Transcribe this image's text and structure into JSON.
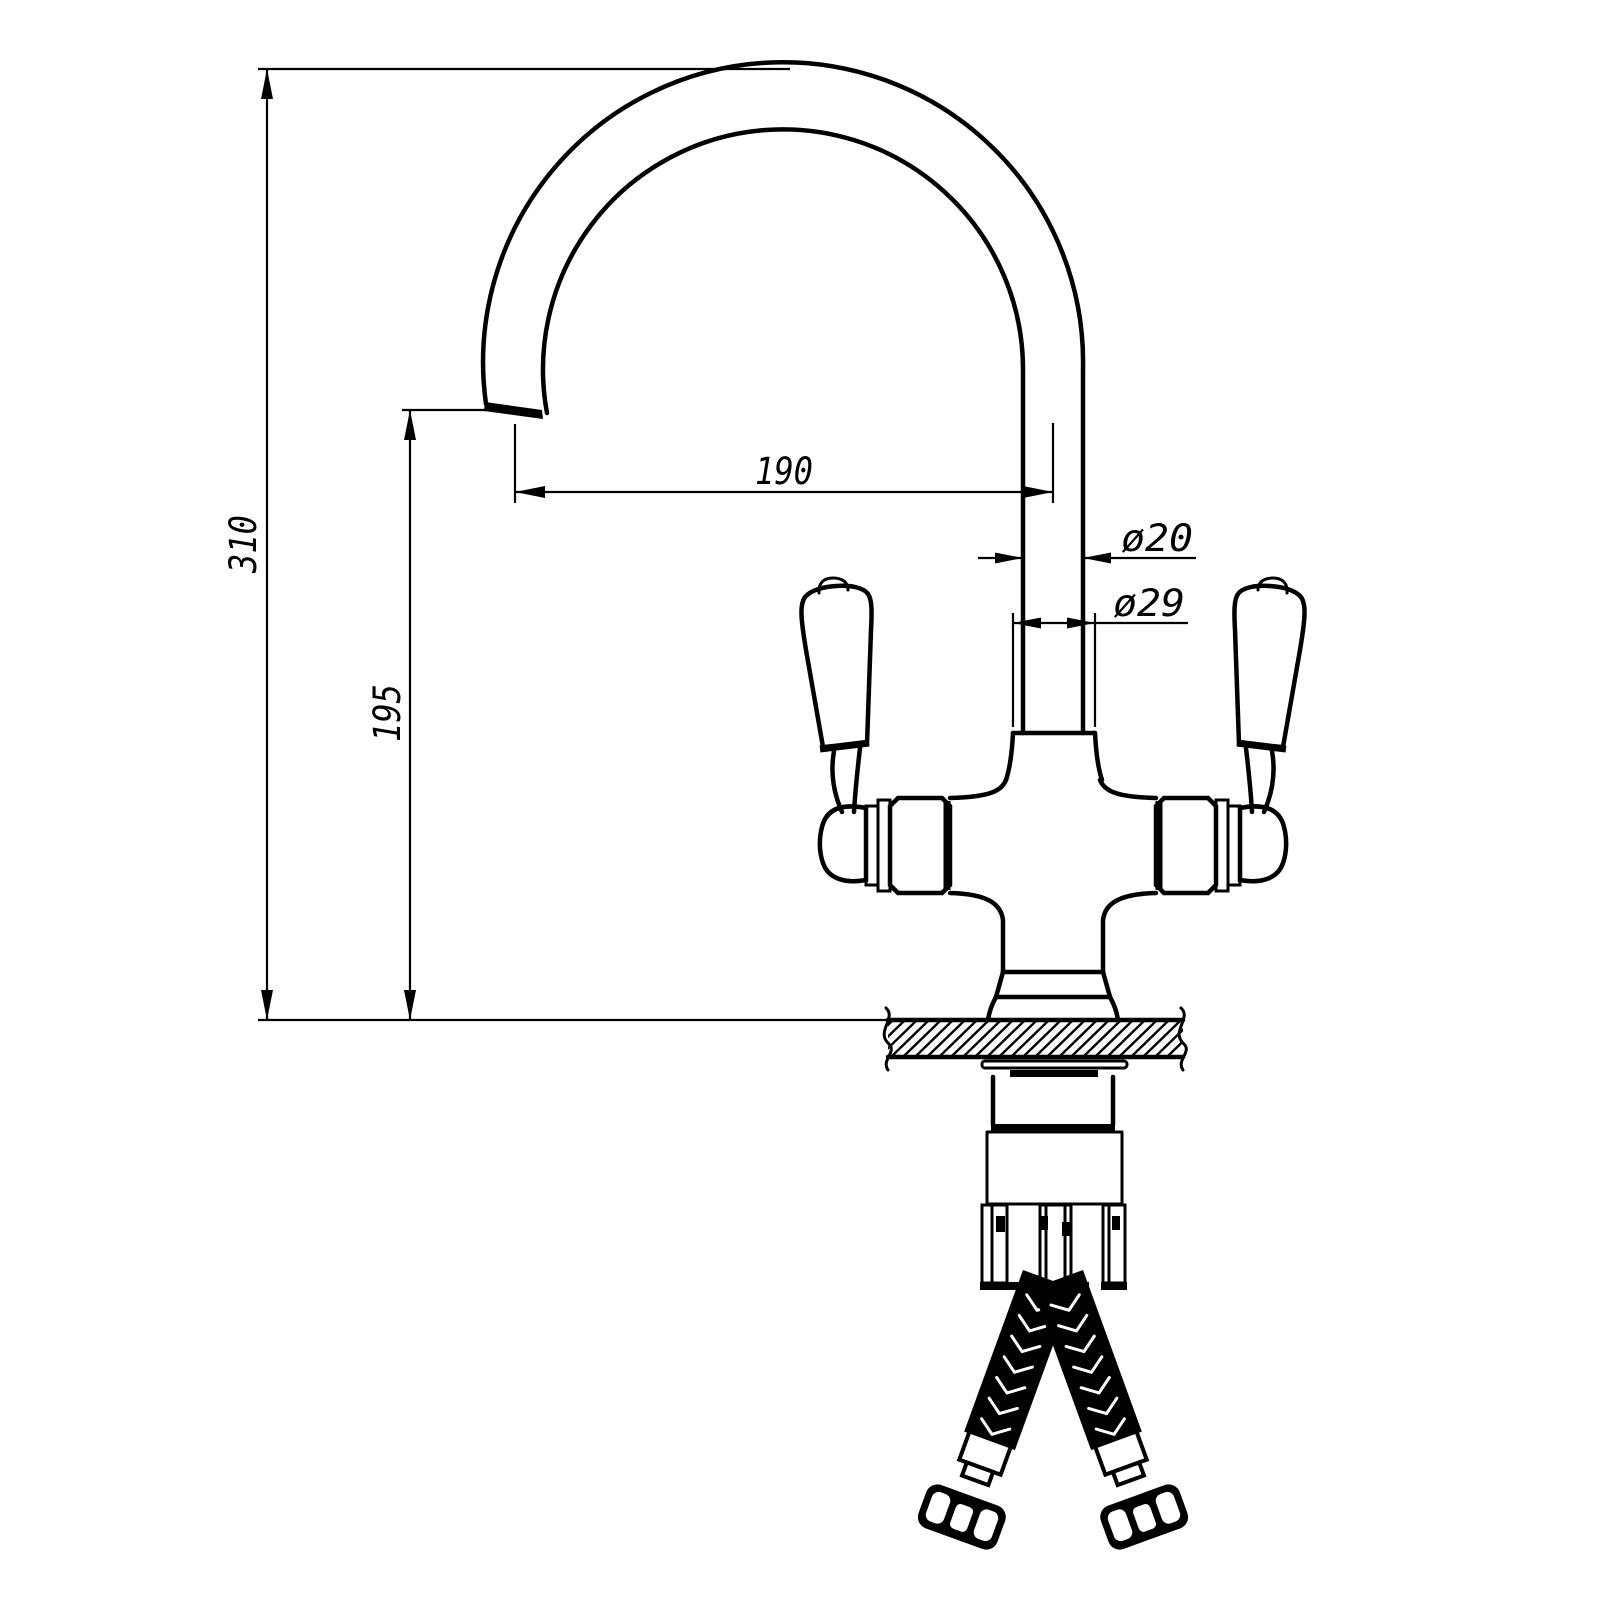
{
  "drawing": {
    "type": "technical-dimension-drawing",
    "subject": "dual-lever kitchen mixer tap, side elevation with flexible supply hoses",
    "colors": {
      "line": "#000000",
      "background": "#ffffff"
    },
    "dimensions": {
      "overall_height": "310",
      "spout_height": "195",
      "spout_reach": "190",
      "spout_tube_diameter": "ø20",
      "body_diameter": "ø29"
    }
  }
}
